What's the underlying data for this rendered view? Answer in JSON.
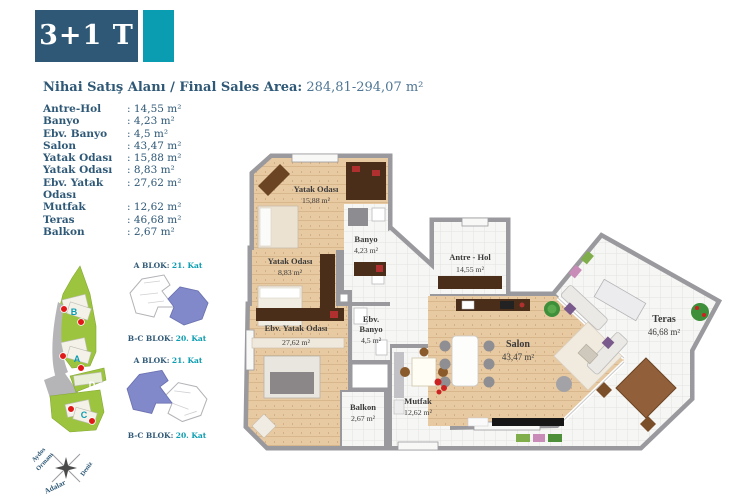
{
  "unit": {
    "type": "3+1 T"
  },
  "sales_area": {
    "label": "Nihai Satış Alanı / Final Sales Area:",
    "value": "284,81-294,07 m²"
  },
  "room_list": [
    {
      "name": "Antre-Hol",
      "value": ": 14,55 m²"
    },
    {
      "name": "Banyo",
      "value": ": 4,23 m²"
    },
    {
      "name": "Ebv. Banyo",
      "value": ": 4,5 m²"
    },
    {
      "name": "Salon",
      "value": ": 43,47 m²"
    },
    {
      "name": "Yatak Odası",
      "value": ": 15,88 m²"
    },
    {
      "name": "Yatak Odası",
      "value": ": 8,83 m²"
    },
    {
      "name": "Ebv. Yatak Odası",
      "value": ": 27,62 m²"
    },
    {
      "name": "Mutfak",
      "value": ": 12,62 m²"
    },
    {
      "name": "Teras",
      "value": ": 46,68 m²"
    },
    {
      "name": "Balkon",
      "value": ": 2,67 m²"
    }
  ],
  "plan": {
    "labels": [
      {
        "lines": [
          "Yatak Odası",
          "15,88 m²"
        ]
      },
      {
        "lines": [
          "Banyo",
          "4,23 m²"
        ]
      },
      {
        "lines": [
          "Yatak Odası",
          "8,83 m²"
        ]
      },
      {
        "lines": [
          "Antre - Hol",
          "14,55 m²"
        ]
      },
      {
        "lines": [
          "Ebv. Yatak Odası",
          "27,62 m²"
        ]
      },
      {
        "lines": [
          "Ebv.",
          "Banyo",
          "4,5 m²"
        ]
      },
      {
        "lines": [
          "Balkon",
          "2,67 m²"
        ]
      },
      {
        "lines": [
          "Mutfak",
          "12,62 m²"
        ]
      },
      {
        "lines": [
          "Salon",
          "43,47 m²"
        ]
      },
      {
        "lines": [
          "Teras",
          "46,68 m²"
        ]
      }
    ]
  },
  "site": {
    "markers": [
      "B",
      "A",
      "D",
      "C"
    ]
  },
  "diagrams": [
    {
      "top_block": "A BLOK:",
      "top_floor": "21. Kat",
      "bottom_block": "B-C BLOK:",
      "bottom_floor": "20. Kat"
    },
    {
      "top_block": "A BLOK:",
      "top_floor": "21. Kat",
      "bottom_block": "B-C BLOK:",
      "bottom_floor": "20. Kat"
    }
  ],
  "compass": {
    "line1": "Aydos",
    "line2": "Ormanı",
    "islands": "Adalar",
    "sea": "Deniz"
  },
  "colors": {
    "navy": "#2e5876",
    "teal": "#0a9db1",
    "wall": "#9a9a9e",
    "wood": "#e7c9a2",
    "tile": "#f6f6f4",
    "highlight": "#8289ca",
    "marker_red": "#e01818",
    "site_green": "#9cc43e"
  }
}
